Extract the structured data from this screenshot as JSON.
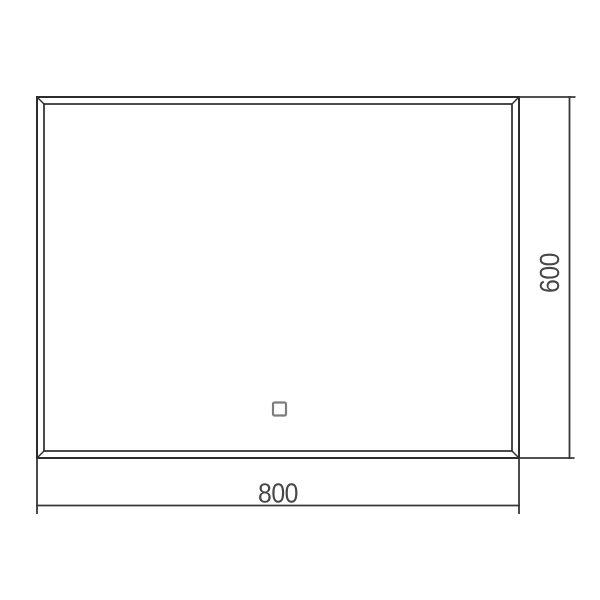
{
  "drawing": {
    "subject": "mirror-front-elevation",
    "dimensions": {
      "width": {
        "label": "800"
      },
      "height": {
        "label": "600"
      }
    },
    "icons": {
      "touch_sensor": "square-touch-button"
    },
    "colors": {
      "background": "#ffffff",
      "frame_line": "#2c2c2c",
      "dimension_line": "#383838",
      "dimension_text": "#474747",
      "touch_sensor_border": "#7d7d7d",
      "touch_sensor_fill": "#fdfdfd"
    }
  }
}
